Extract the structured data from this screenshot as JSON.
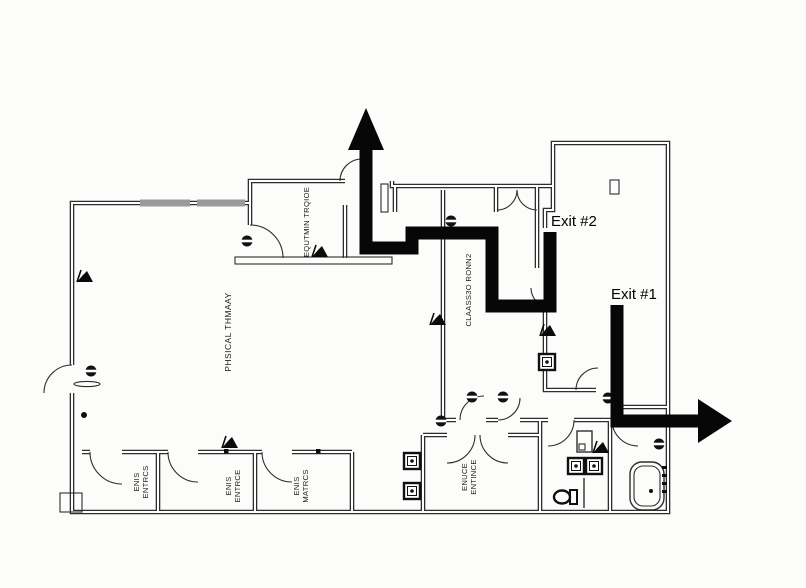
{
  "floorplan": {
    "background_color": "#fcfcfa",
    "wall_color": "#2e2e2e",
    "route_color": "#070707",
    "window_color": "#9a9a9a",
    "exits": {
      "exit1": "Exit #1",
      "exit2": "Exit #2"
    },
    "rooms": {
      "physical_therapy": "PHSICAL THMAAY",
      "equipment_storage": "EQUTMIN TRQIOE",
      "classroom2": "CLAASS3O RONN2",
      "office1_line1": "ENIS",
      "office1_line2": "ENTRCS",
      "office2_line1": "ENIS",
      "office2_line2": "ENTRCE",
      "office3_line1": "ENIS",
      "office3_line2": "MATRCS",
      "entry_line1": "ENUCE",
      "entry_line2": "ENTINCE"
    },
    "icons": {
      "door_hardware": "circle-with-bar",
      "door_marker": "black-flag",
      "outlet_box": "square-with-dot",
      "exit_route_up": "up-arrow",
      "exit_route_right": "right-arrow"
    }
  }
}
